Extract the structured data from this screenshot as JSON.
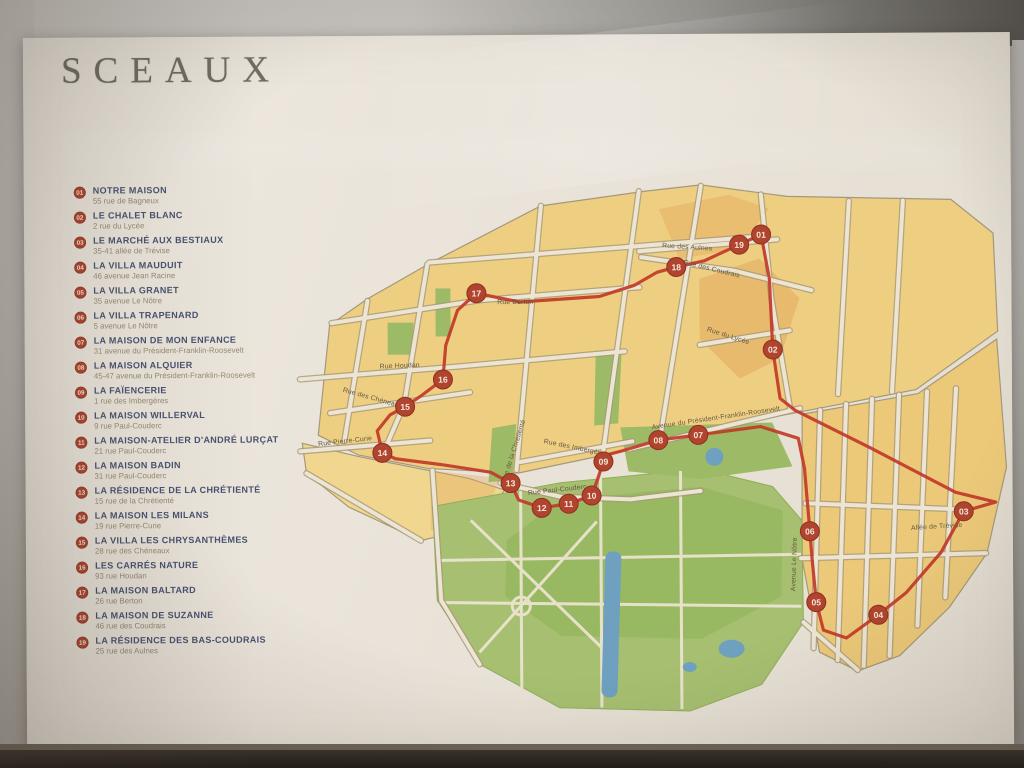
{
  "poster": {
    "title": "SCEAUX",
    "legend": [
      {
        "num": "01",
        "name": "NOTRE MAISON",
        "address": "55 rue de Bagneux"
      },
      {
        "num": "02",
        "name": "LE CHALET BLANC",
        "address": "2 rue du Lycée"
      },
      {
        "num": "03",
        "name": "LE MARCHÉ AUX BESTIAUX",
        "address": "35-41 allée de Trévise"
      },
      {
        "num": "04",
        "name": "LA VILLA MAUDUIT",
        "address": "46 avenue Jean Racine"
      },
      {
        "num": "05",
        "name": "LA VILLA GRANET",
        "address": "35 avenue Le Nôtre"
      },
      {
        "num": "06",
        "name": "LA VILLA TRAPENARD",
        "address": "5 avenue Le Nôtre"
      },
      {
        "num": "07",
        "name": "LA MAISON DE MON ENFANCE",
        "address": "31 avenue du Président-Franklin-Roosevelt"
      },
      {
        "num": "08",
        "name": "LA MAISON ALQUIER",
        "address": "45-47 avenue du Président-Franklin-Roosevelt"
      },
      {
        "num": "09",
        "name": "LA FAÏENCERIE",
        "address": "1 rue des Imbergères"
      },
      {
        "num": "10",
        "name": "LA MAISON WILLERVAL",
        "address": "9 rue Paul-Couderc"
      },
      {
        "num": "11",
        "name": "LA MAISON-ATELIER D'ANDRÉ LURÇAT",
        "address": "21 rue Paul-Couderc"
      },
      {
        "num": "12",
        "name": "LA MAISON BADIN",
        "address": "31 rue Paul-Couderc"
      },
      {
        "num": "13",
        "name": "LA RÉSIDENCE DE LA CHRÉTIENTÉ",
        "address": "15 rue de la Chrétienté"
      },
      {
        "num": "14",
        "name": "LA MAISON LES MILANS",
        "address": "19 rue Pierre-Curie"
      },
      {
        "num": "15",
        "name": "LA VILLA LES CHRYSANTHÈMES",
        "address": "28 rue des Chéneaux"
      },
      {
        "num": "16",
        "name": "LES CARRÉS NATURE",
        "address": "93 rue Houdan"
      },
      {
        "num": "17",
        "name": "LA MAISON BALTARD",
        "address": "26 rue Berton"
      },
      {
        "num": "18",
        "name": "LA MAISON DE SUZANNE",
        "address": "46 rue des Coudrais"
      },
      {
        "num": "19",
        "name": "LA RÉSIDENCE DES BAS-COUDRAIS",
        "address": "25 rue des Aulnes"
      }
    ],
    "map": {
      "colors": {
        "route": "#c23a28",
        "marker": "#b0442e",
        "block": "#eecf82",
        "park": "#a6bf70",
        "water": "#6fa0bf"
      },
      "streets": [
        {
          "label": "Rue des Aulnes",
          "x": 688,
          "y": 250,
          "angle": 4
        },
        {
          "label": "Rue des Coudrais",
          "x": 712,
          "y": 272,
          "angle": 14
        },
        {
          "label": "Rue Berton",
          "x": 516,
          "y": 304,
          "angle": 0
        },
        {
          "label": "Rue du Lycée",
          "x": 728,
          "y": 339,
          "angle": 18
        },
        {
          "label": "Rue Houdan",
          "x": 400,
          "y": 367,
          "angle": -2
        },
        {
          "label": "Rue des Chéneaux",
          "x": 372,
          "y": 399,
          "angle": 16
        },
        {
          "label": "Rue Pierre-Curie",
          "x": 345,
          "y": 442,
          "angle": -6
        },
        {
          "label": "Rue de la Chrétienté",
          "x": 515,
          "y": 452,
          "angle": -72
        },
        {
          "label": "Rue des Imbergères",
          "x": 575,
          "y": 450,
          "angle": 12
        },
        {
          "label": "Rue Paul-Couderc",
          "x": 557,
          "y": 492,
          "angle": -6
        },
        {
          "label": "Avenue du Président-Franklin-Roosevelt",
          "x": 716,
          "y": 421,
          "angle": -8
        },
        {
          "label": "Avenue Le Nôtre",
          "x": 795,
          "y": 566,
          "angle": -88
        },
        {
          "label": "Allée de Trévise",
          "x": 936,
          "y": 531,
          "angle": -3
        }
      ],
      "markers": [
        {
          "num": "01",
          "x": 762,
          "y": 236
        },
        {
          "num": "02",
          "x": 773,
          "y": 351
        },
        {
          "num": "03",
          "x": 963,
          "y": 514
        },
        {
          "num": "04",
          "x": 877,
          "y": 617
        },
        {
          "num": "05",
          "x": 815,
          "y": 604
        },
        {
          "num": "06",
          "x": 809,
          "y": 533
        },
        {
          "num": "07",
          "x": 698,
          "y": 436
        },
        {
          "num": "08",
          "x": 658,
          "y": 441
        },
        {
          "num": "09",
          "x": 603,
          "y": 462
        },
        {
          "num": "10",
          "x": 591,
          "y": 496
        },
        {
          "num": "11",
          "x": 568,
          "y": 504
        },
        {
          "num": "12",
          "x": 541,
          "y": 508
        },
        {
          "num": "13",
          "x": 510,
          "y": 483
        },
        {
          "num": "14",
          "x": 382,
          "y": 452
        },
        {
          "num": "15",
          "x": 405,
          "y": 406
        },
        {
          "num": "16",
          "x": 443,
          "y": 379
        },
        {
          "num": "17",
          "x": 477,
          "y": 293
        },
        {
          "num": "18",
          "x": 677,
          "y": 268
        },
        {
          "num": "19",
          "x": 740,
          "y": 246
        }
      ],
      "route": [
        [
          762,
          236
        ],
        [
          770,
          280
        ],
        [
          773,
          351
        ],
        [
          780,
          400
        ],
        [
          795,
          412
        ],
        [
          870,
          450
        ],
        [
          955,
          495
        ],
        [
          995,
          505
        ],
        [
          963,
          514
        ],
        [
          940,
          555
        ],
        [
          905,
          595
        ],
        [
          877,
          617
        ],
        [
          845,
          640
        ],
        [
          822,
          632
        ],
        [
          815,
          604
        ],
        [
          811,
          560
        ],
        [
          809,
          533
        ],
        [
          804,
          470
        ],
        [
          798,
          440
        ],
        [
          760,
          428
        ],
        [
          698,
          436
        ],
        [
          658,
          441
        ],
        [
          620,
          452
        ],
        [
          608,
          455
        ],
        [
          603,
          462
        ],
        [
          597,
          480
        ],
        [
          591,
          496
        ],
        [
          568,
          504
        ],
        [
          541,
          508
        ],
        [
          518,
          500
        ],
        [
          510,
          483
        ],
        [
          490,
          472
        ],
        [
          440,
          464
        ],
        [
          395,
          458
        ],
        [
          382,
          452
        ],
        [
          377,
          430
        ],
        [
          390,
          414
        ],
        [
          405,
          406
        ],
        [
          420,
          396
        ],
        [
          443,
          379
        ],
        [
          446,
          345
        ],
        [
          458,
          310
        ],
        [
          477,
          293
        ],
        [
          520,
          302
        ],
        [
          600,
          297
        ],
        [
          635,
          286
        ],
        [
          658,
          273
        ],
        [
          677,
          268
        ],
        [
          705,
          262
        ],
        [
          740,
          246
        ],
        [
          762,
          236
        ]
      ]
    }
  }
}
